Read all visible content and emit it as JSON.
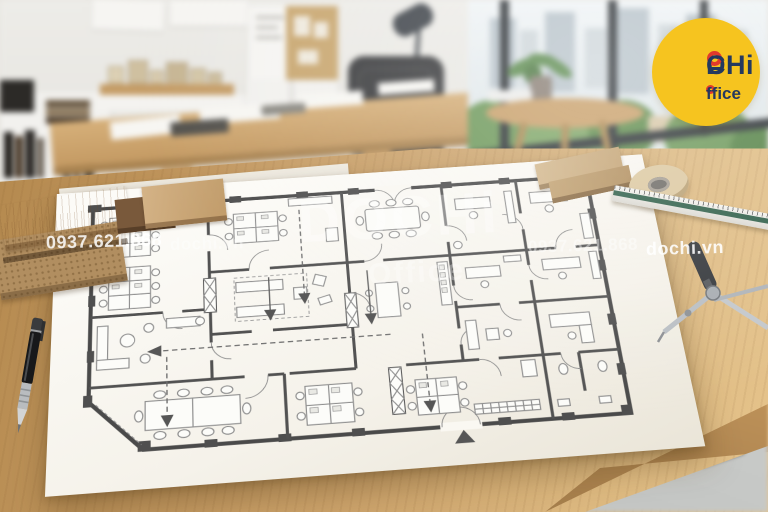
{
  "brand": {
    "name": "DOCHi",
    "name_d": "D",
    "name_rest": "CHi",
    "sub": "Office",
    "sub_rest": "ffice",
    "circle_color": "#F6C41F",
    "text_color": "#24395F",
    "accent_color": "#E23A2C"
  },
  "watermarks": {
    "row": [
      "0937.621.868",
      "dochi.vn",
      "0937.621.868",
      "dochi.vn"
    ],
    "center_title": "DOCHi",
    "center_sub": "Office"
  }
}
